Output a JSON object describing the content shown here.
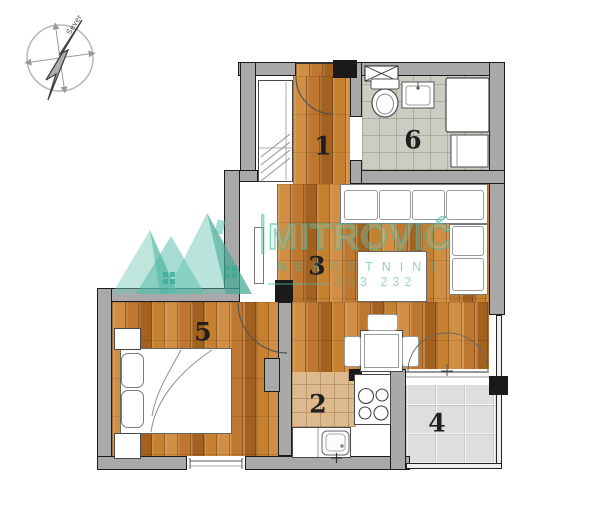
{
  "plan": {
    "compass_label": "Sever",
    "rooms": [
      {
        "number": "1"
      },
      {
        "number": "2"
      },
      {
        "number": "3"
      },
      {
        "number": "4"
      },
      {
        "number": "5"
      },
      {
        "number": "6"
      }
    ]
  },
  "watermark": {
    "brand": "MITROVIĆ",
    "subtitle": "NEKRETNINE",
    "phone_fragment": "063 232"
  },
  "colors": {
    "wood": "#bd7730",
    "wood-dark": "#a2611f",
    "wood-light": "#d08f45",
    "bath-tile": "#cbccc2",
    "kitchen-tile": "#dcba8e",
    "terrace-tile": "#dedede",
    "wall": "#a9a9a9",
    "wall-dark": "#1c1c1c",
    "brand-teal": "#4bb49a"
  }
}
